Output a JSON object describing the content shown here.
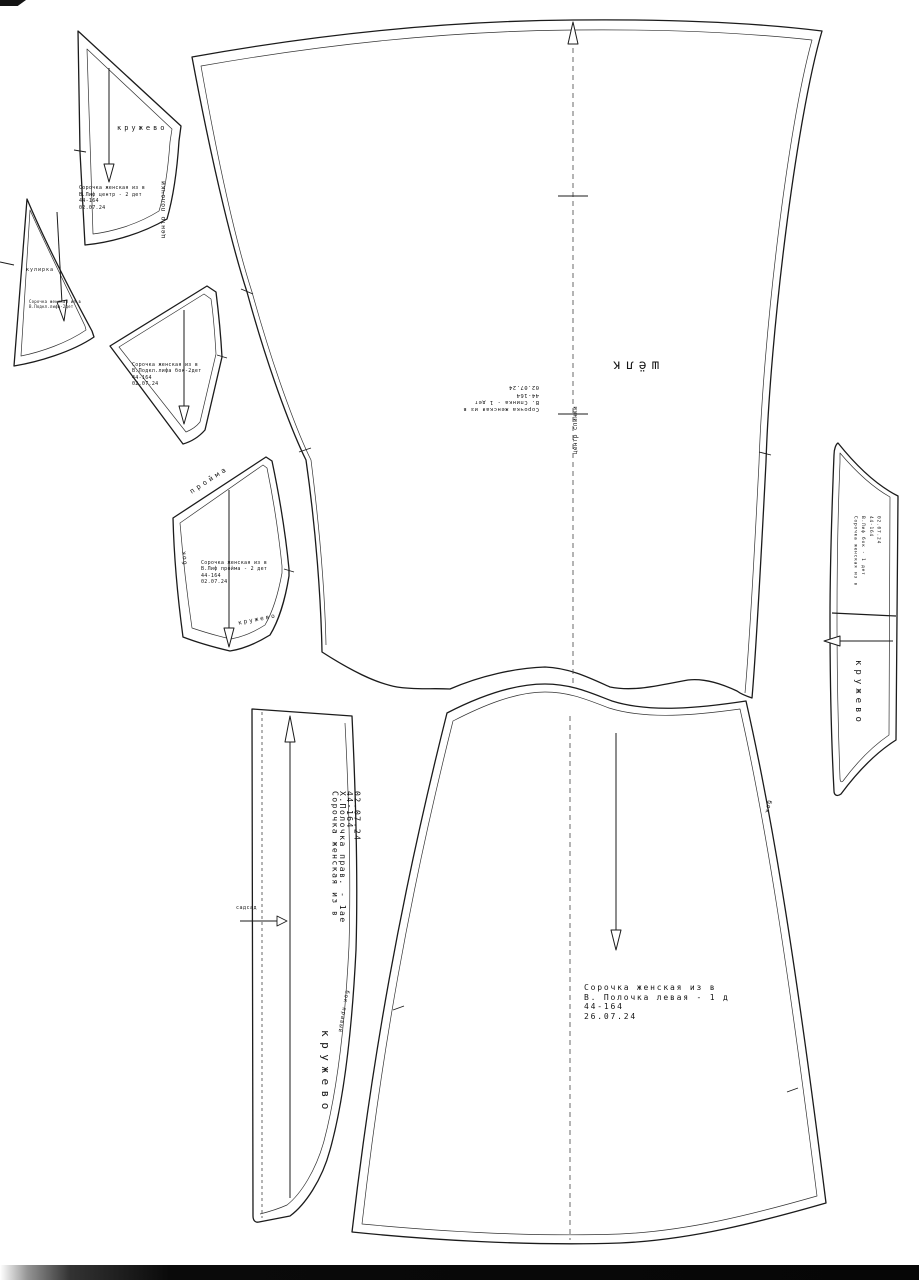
{
  "canvas": {
    "background": "#ffffff",
    "line_color": "#1b1b1b"
  },
  "pieces": {
    "bodice_center": {
      "fabric": "кружево",
      "edge_label": "центр полочки",
      "info": [
        "Сорочка женская из в",
        "В.Лиф центр - 2 дет",
        "44-164",
        "02.07.24"
      ]
    },
    "lining_center": {
      "fabric": "кулирка",
      "info": [
        "Сорочка женская из в",
        "В.Подкл.лифа-2дет"
      ]
    },
    "lining_side": {
      "info": [
        "Сорочка женская из в",
        "В.Подкл.лифа бок-2дет",
        "44-164",
        "02.07.24"
      ]
    },
    "bodice_armhole": {
      "fabric": "кружево",
      "edge_top": "пройма",
      "edge_left": "бок",
      "info": [
        "Сорочка женская из в",
        "В.Лиф пройма - 2 дет",
        "44-164",
        "02.07.24"
      ]
    },
    "back": {
      "fabric": "шёлк",
      "edge_label": "центр спинки",
      "info": [
        "Сорочка женская из в",
        "В. Спинка - 1 дет",
        "44-164",
        "02.07.24"
      ]
    },
    "side_band": {
      "fabric": "кружево",
      "info": [
        "Сорочка женская из в",
        "В.Лиф бок - 1 дет",
        "44-164",
        "02.07.24"
      ]
    },
    "front_right": {
      "fabric": "кружево",
      "edge_label": "бок правый",
      "notch_label": "садсад",
      "info": [
        "Сорочка женская из в",
        "Х.Полочка прав. - 1ае",
        "44-164",
        "02.07.24"
      ]
    },
    "front_left": {
      "edge_label": "бок",
      "info": [
        "Сорочка женская из в",
        "В. Полочка левая - 1 д",
        "44-164",
        "26.07.24"
      ]
    }
  }
}
